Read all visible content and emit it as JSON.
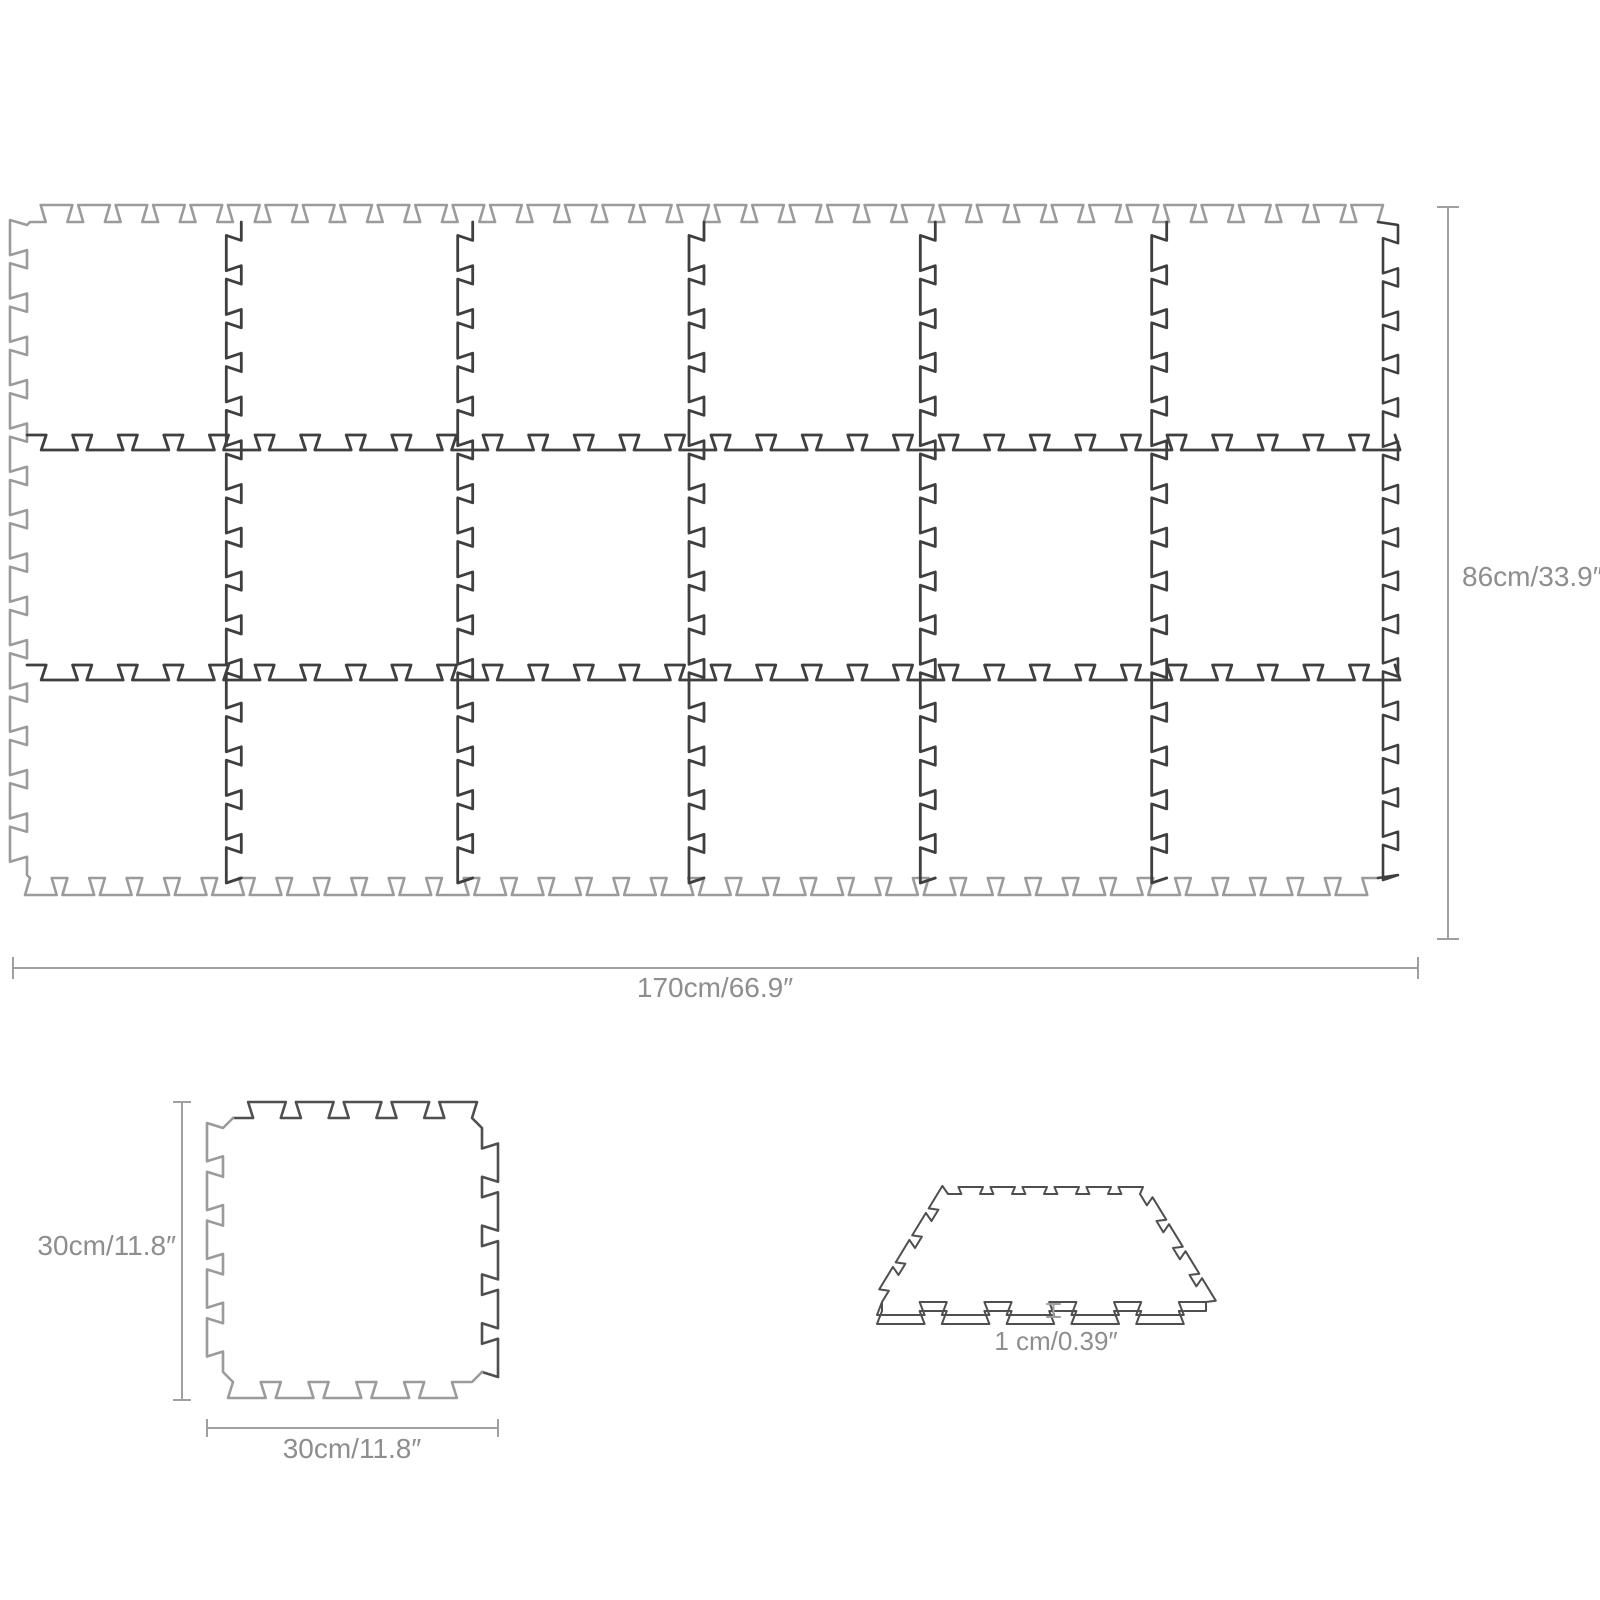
{
  "mat_grid": {
    "rows": 3,
    "cols": 6,
    "tile_count": 18,
    "width_label": "170cm/66.9″",
    "height_label": "86cm/33.9″"
  },
  "single_tile": {
    "width_label": "30cm/11.8″",
    "height_label": "30cm/11.8″"
  },
  "thickness": {
    "label": "1 cm/0.39″"
  },
  "colors": {
    "outline_light": "#9b9b9b",
    "outline_dark": "#3f3f3f",
    "tile_dark": "#4f4f4f",
    "dimension_line": "#a0a0a0",
    "label_text": "#8e8e8e",
    "background": "#ffffff"
  }
}
